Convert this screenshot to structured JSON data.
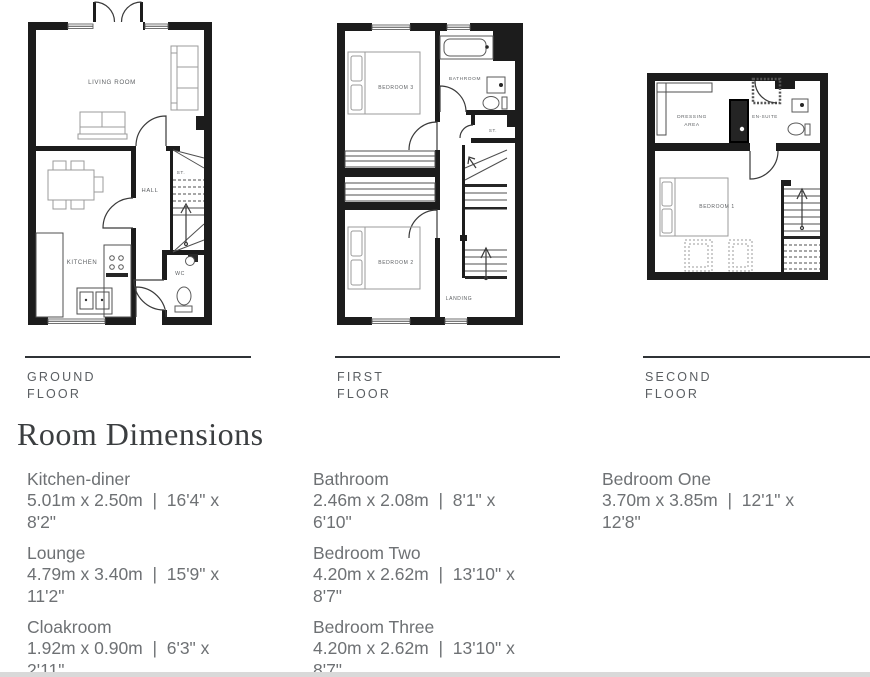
{
  "plans": {
    "ground": {
      "floor_label": [
        "GROUND",
        "FLOOR"
      ],
      "rooms": {
        "living_room": "LIVING ROOM",
        "hall": "HALL",
        "store": "ST.",
        "kitchen": "KITCHEN",
        "wc": "WC"
      }
    },
    "first": {
      "floor_label": [
        "FIRST",
        "FLOOR"
      ],
      "rooms": {
        "bedroom3": "BEDROOM 3",
        "bathroom": "BATHROOM",
        "store": "ST.",
        "bedroom2": "BEDROOM 2",
        "landing": "LANDING"
      }
    },
    "second": {
      "floor_label": [
        "SECOND",
        "FLOOR"
      ],
      "rooms": {
        "dressing_line1": "DRESSING",
        "dressing_line2": "AREA",
        "ensuite": "EN-SUITE",
        "bedroom1": "BEDROOM 1"
      }
    }
  },
  "heading": "Room Dimensions",
  "dimensions": {
    "columns": [
      {
        "entries": [
          {
            "name": "Kitchen-diner",
            "lines": [
              "5.01m x 2.50m  |  16'4\" x",
              "8'2\""
            ]
          },
          {
            "name": "Lounge",
            "lines": [
              "4.79m x 3.40m  |  15'9\" x",
              "11'2\""
            ]
          },
          {
            "name": "Cloakroom",
            "lines": [
              "1.92m x 0.90m  |  6'3\" x",
              "2'11\""
            ]
          }
        ]
      },
      {
        "entries": [
          {
            "name": "Bathroom",
            "lines": [
              "2.46m x 2.08m  |  8'1\" x",
              "6'10\""
            ]
          },
          {
            "name": "Bedroom Two",
            "lines": [
              "4.20m x 2.62m  |  13'10\" x",
              "8'7\""
            ]
          },
          {
            "name": "Bedroom Three",
            "lines": [
              "4.20m x 2.62m  |  13'10\" x",
              "8'7\""
            ]
          }
        ]
      },
      {
        "entries": [
          {
            "name": "Bedroom One",
            "lines": [
              "3.70m x 3.85m  |  12'1\" x",
              "12'8\""
            ]
          }
        ]
      }
    ]
  }
}
